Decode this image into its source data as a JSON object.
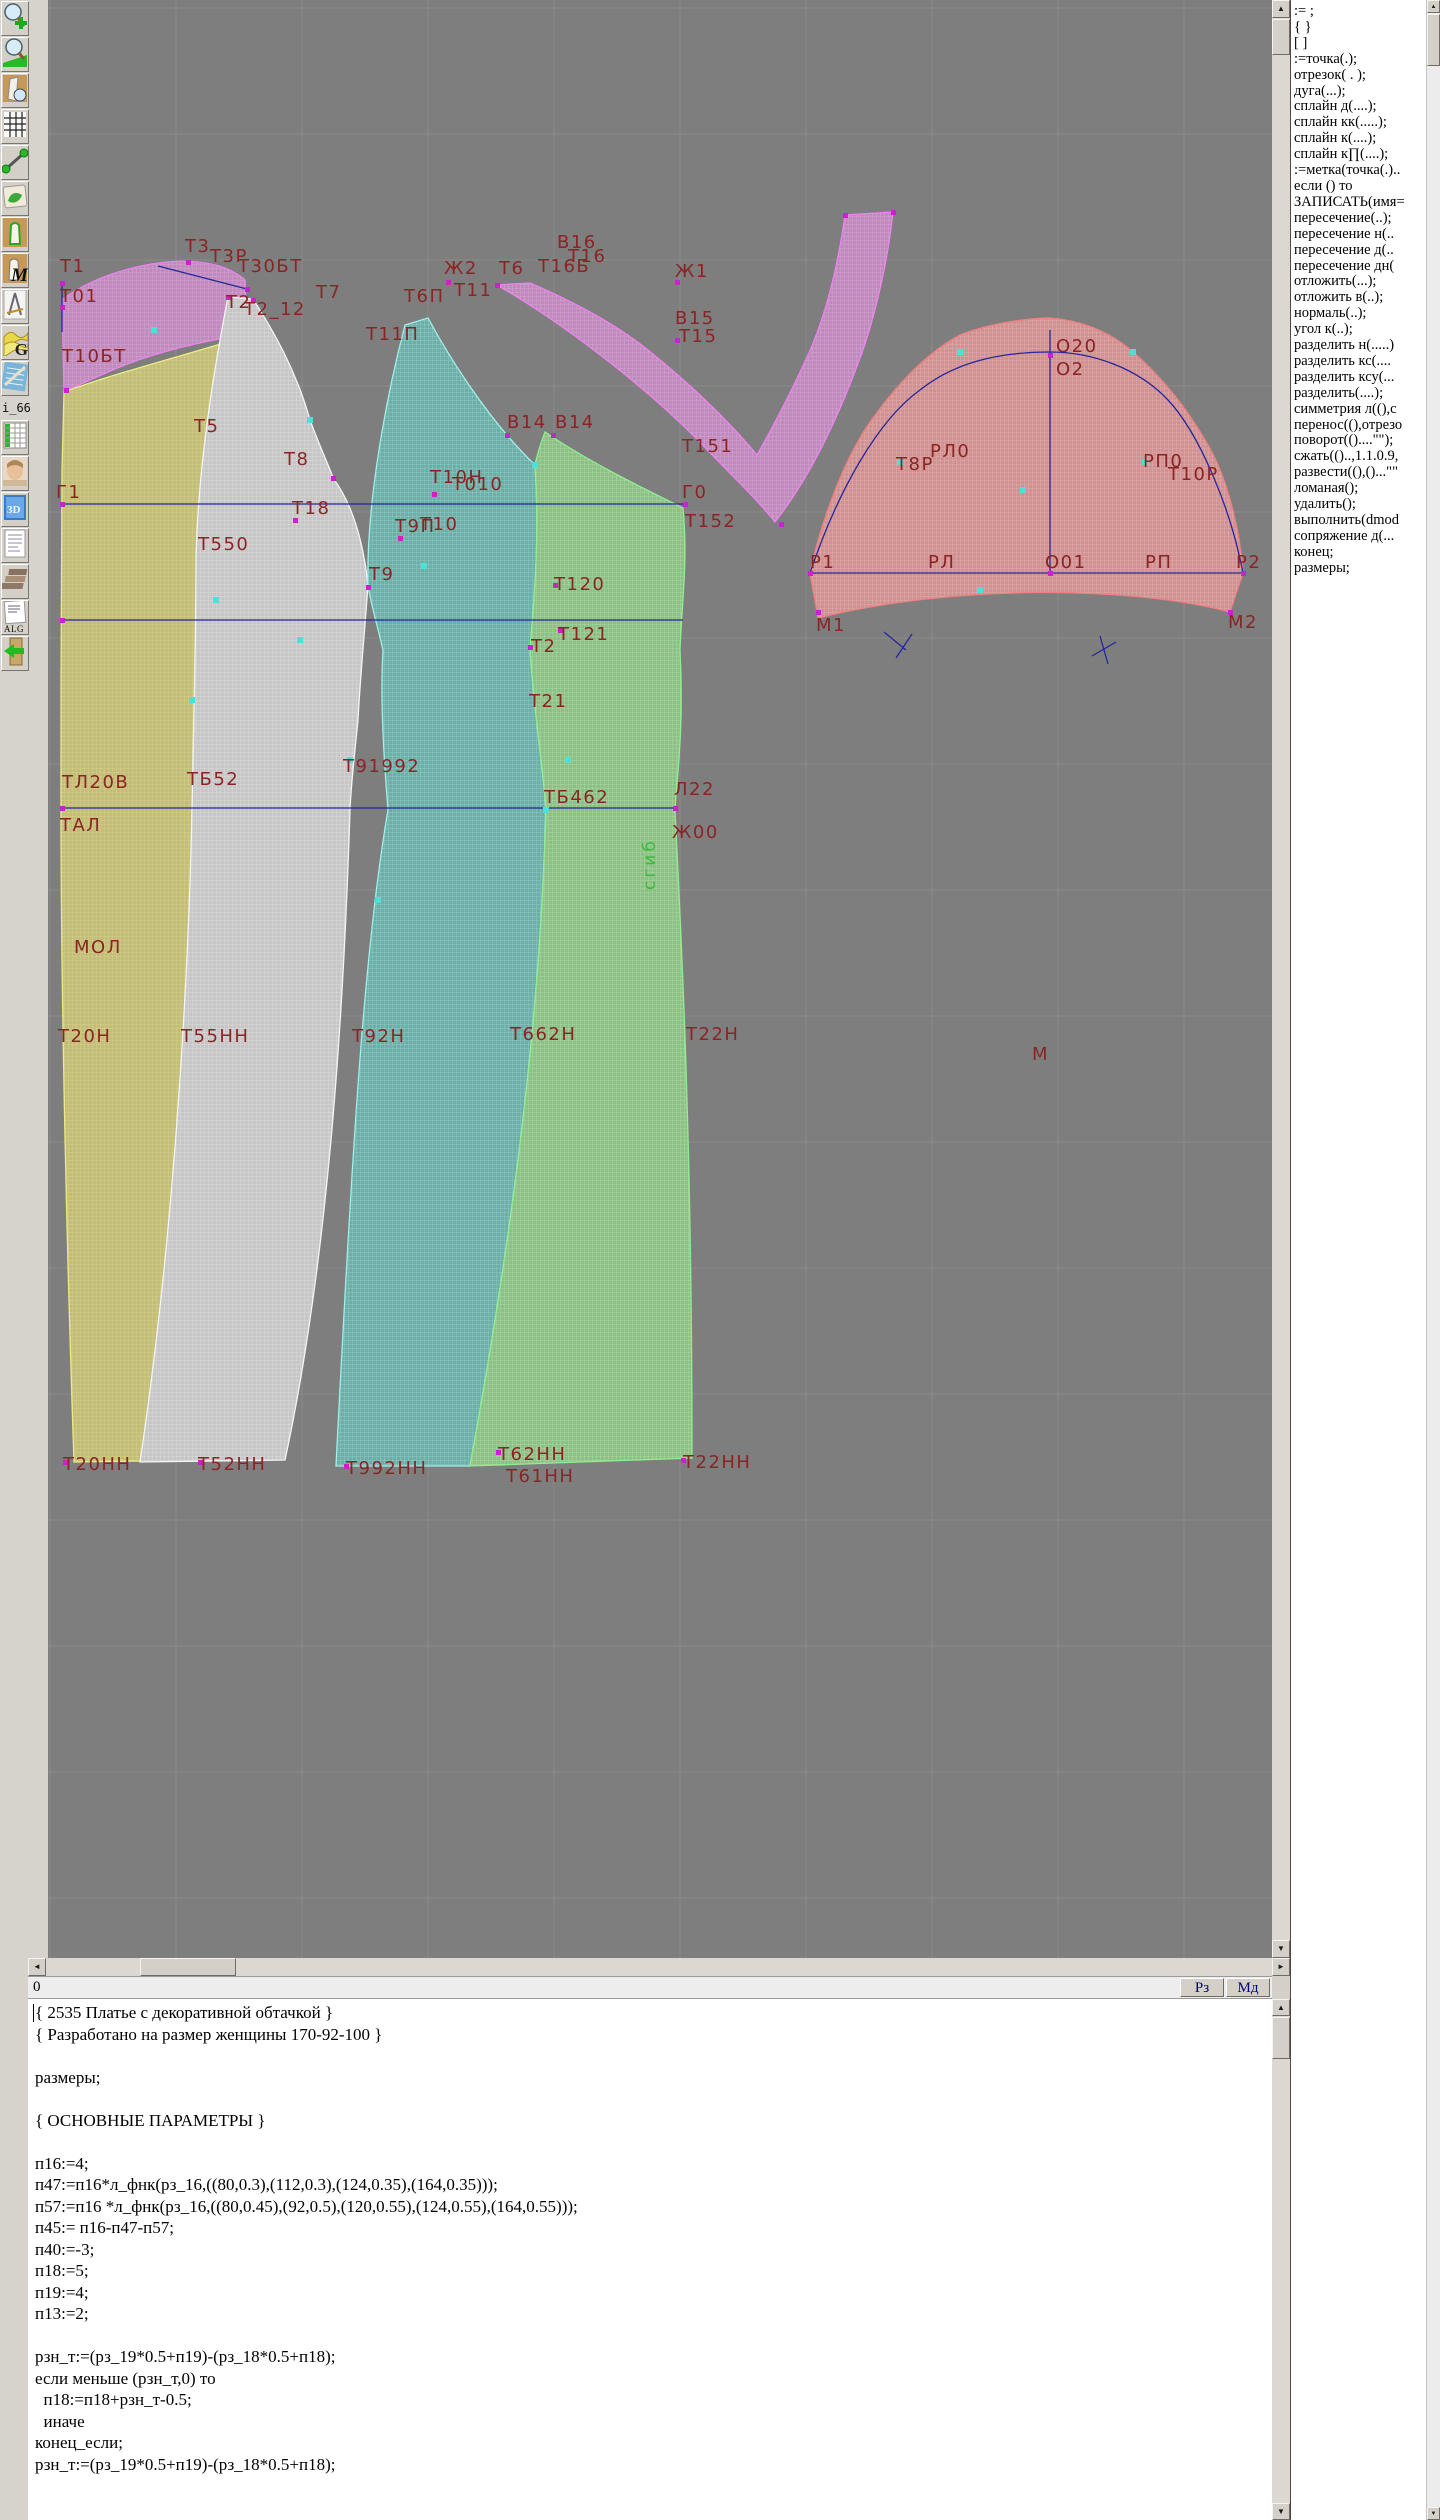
{
  "toolbar": {
    "items": [
      {
        "name": "zoom-in"
      },
      {
        "name": "zoom-out"
      },
      {
        "name": "view-pattern"
      },
      {
        "name": "grid"
      },
      {
        "name": "segment"
      },
      {
        "name": "map"
      },
      {
        "name": "pattern-outline"
      },
      {
        "name": "pattern-m",
        "label": "M"
      },
      {
        "name": "drafting-tools"
      },
      {
        "name": "g-curves",
        "label": "G"
      },
      {
        "name": "blueprint"
      },
      {
        "name": "i66",
        "label": "i_66."
      },
      {
        "name": "table"
      },
      {
        "name": "photo"
      },
      {
        "name": "threed",
        "label": "3D"
      },
      {
        "name": "list"
      },
      {
        "name": "books"
      },
      {
        "name": "alg",
        "label": "ALG"
      },
      {
        "name": "exit"
      }
    ]
  },
  "right_panel": {
    "lines": [
      ":=  ;",
      "{  }",
      "[  ]",
      ":=точка(.);",
      "отрезок( . );",
      "дуга(...);",
      "сплайн  д(....);",
      "сплайн  кк(.....);",
      "сплайн  к(....);",
      "сплайн  к∏(....);",
      ":=метка(точка(.)..",
      "если () то",
      "ЗАПИСАТЬ(имя=",
      "пересечение(..);",
      "пересечение  н(..",
      "пересечение  д(..",
      "пересечение  дн(",
      "отложить(...);",
      "отложить  в(..);",
      "нормаль(..);",
      "угол  к(..);",
      "разделить  н(.....)",
      "разделить  кс(....",
      "разделить  ксу(...",
      "разделить(....);",
      "симметрия  л((),с",
      "перенос((),отрезо",
      "поворот(()....\"\");",
      "сжать(()..,1.1.0.9,",
      "развести((),()...\"\"",
      "ломаная();",
      "удалить();",
      "выполнить(dmod",
      "сопряжение  д(...",
      "конец;",
      "размеры;"
    ]
  },
  "bottom": {
    "ruler_label": "0",
    "buttons": [
      "Рз",
      "Мд"
    ]
  },
  "editor": {
    "lines": [
      "{ 2535 Платье с декоративной обтачкой }",
      "{ Разработано на размер женщины 170-92-100 }",
      "",
      "размеры;",
      "",
      "{ ОСНОВНЫЕ ПАРАМЕТРЫ }",
      "",
      "п16:=4;",
      "п47:=п16*л_фнк(рз_16,((80,0.3),(112,0.3),(124,0.35),(164,0.35)));",
      "п57:=п16 *л_фнк(рз_16,((80,0.45),(92,0.5),(120,0.55),(124,0.55),(164,0.55)));",
      "п45:= п16-п47-п57;",
      "п40:=-3;",
      "п18:=5;",
      "п19:=4;",
      "п13:=2;",
      "",
      "рзн_т:=(рз_19*0.5+п19)-(рз_18*0.5+п18);",
      "если меньше (рзн_т,0) то",
      "  п18:=п18+рзн_т-0.5;",
      "  иначе",
      "конец_если;",
      "рзн_т:=(рз_19*0.5+п19)-(рз_18*0.5+п18);"
    ]
  },
  "canvas": {
    "colors": {
      "bg": "#7e7e7e",
      "grid": "#8a8a8a",
      "line_blue": "#26269c",
      "label_red": "#8b2424",
      "vlabel_green": "#3dbb3d"
    },
    "grid": {
      "spacing": 126,
      "x0": 2,
      "y0": 8
    },
    "pieces": [
      {
        "name": "neck-facing-left",
        "base": "#bf8bbc",
        "mesh": "#dca6d9",
        "edge": "#ee82ee",
        "path": "M14,300 C50,272 110,258 150,262 C170,264 186,270 197,280 L199,334 C150,342 100,354 60,372 C42,380 26,387 16,392 Z"
      },
      {
        "name": "back-panel-yellow",
        "base": "#c2bd7d",
        "mesh": "#dcd77e",
        "edge": "#eeeb84",
        "path": "M16,392 C70,372 150,352 198,336 L203,450 C195,520 172,560 164,620 C156,700 150,760 146,810 C142,980 150,1230 163,1460 L26,1462 C18,1230 13,980 13,810 C13,700 13,560 14,470 Z"
      },
      {
        "name": "side-panel-white",
        "base": "#c6c6c6",
        "mesh": "#e0e0e0",
        "edge": "#f4f4f4",
        "path": "M180,297 L205,299 C225,330 248,370 262,420 C275,455 283,470 285,478 C300,498 314,530 320,585 C316,640 312,680 310,720 C306,760 303,785 302,810 C296,1000 282,1250 237,1460 L92,1462 C124,1250 140,1000 144,810 C146,700 148,640 148,560 C150,470 164,380 180,297 Z"
      },
      {
        "name": "front-panel-teal",
        "base": "#6fada7",
        "mesh": "#92d4ce",
        "edge": "#9ff0e8",
        "path": "M357,325 L380,318 C400,355 440,420 487,465 C492,540 486,600 482,650 C488,730 496,775 498,810 C494,950 480,1150 422,1466 L288,1466 C304,1150 316,950 340,810 C336,760 332,700 335,650 C328,620 322,600 320,585 C318,500 340,390 357,325 Z"
      },
      {
        "name": "front-panel-green",
        "base": "#8fbf88",
        "mesh": "#ace0a0",
        "edge": "#90ee90",
        "path": "M497,432 C550,468 610,495 635,508 C640,560 634,600 632,650 C636,730 629,775 627,810 C634,950 644,1150 644,1458 L422,1466 C480,1150 494,950 498,810 C496,775 488,730 482,650 C486,600 492,540 487,465 C490,450 494,440 497,432 Z"
      },
      {
        "name": "decorative-facing-v",
        "base": "#bf8bbc",
        "mesh": "#dca6d9",
        "edge": "#ee82ee",
        "path": "M449,285 C510,320 590,380 650,440 C680,472 710,500 727,522 C760,480 790,420 815,350 C828,312 840,260 845,212 L797,215 C790,265 778,315 760,355 C745,388 726,425 709,455 C680,420 640,382 600,350 C560,318 510,295 482,283 Z"
      },
      {
        "name": "sleeve-red",
        "base": "#cf9191",
        "mesh": "#e8b2b2",
        "edge": "#f08080",
        "path": "M762,573 C770,535 790,470 820,425 C850,382 880,352 912,335 C945,322 985,318 1002,318 C1030,320 1060,330 1085,352 C1115,378 1140,410 1160,445 C1180,480 1192,530 1195,573 L1182,612 C1080,585 900,585 770,618 Z"
      }
    ],
    "blue_lines": [
      [
        14,
        504,
        638,
        504
      ],
      [
        14,
        620,
        635,
        620
      ],
      [
        14,
        808,
        627,
        808
      ],
      [
        110,
        266,
        199,
        289
      ],
      [
        14,
        283,
        14,
        332
      ],
      [
        762,
        573,
        1195,
        573
      ],
      [
        1002,
        330,
        1002,
        573
      ],
      [
        836,
        632,
        858,
        650
      ],
      [
        848,
        658,
        864,
        634
      ],
      [
        1044,
        656,
        1068,
        642
      ],
      [
        1052,
        636,
        1060,
        664
      ]
    ],
    "blue_curves": [
      "M762,573 C790,490 830,420 872,390 C912,358 962,352 1002,352 C1044,352 1090,368 1120,400 C1150,432 1182,505 1195,573"
    ],
    "markers": {
      "magenta": [
        [
          14,
          283
        ],
        [
          14,
          307
        ],
        [
          18,
          390
        ],
        [
          140,
          262
        ],
        [
          199,
          289
        ],
        [
          180,
          297
        ],
        [
          205,
          300
        ],
        [
          247,
          520
        ],
        [
          285,
          478
        ],
        [
          320,
          587
        ],
        [
          352,
          538
        ],
        [
          386,
          494
        ],
        [
          400,
          282
        ],
        [
          482,
          647
        ],
        [
          507,
          585
        ],
        [
          512,
          630
        ],
        [
          14,
          504
        ],
        [
          14,
          620
        ],
        [
          14,
          808
        ],
        [
          637,
          504
        ],
        [
          627,
          808
        ],
        [
          629,
          282
        ],
        [
          629,
          340
        ],
        [
          733,
          524
        ],
        [
          762,
          573
        ],
        [
          1002,
          355
        ],
        [
          1002,
          573
        ],
        [
          1195,
          573
        ],
        [
          770,
          612
        ],
        [
          1182,
          612
        ],
        [
          459,
          435
        ],
        [
          505,
          435
        ],
        [
          449,
          285
        ],
        [
          797,
          215
        ],
        [
          845,
          212
        ],
        [
          17,
          1462
        ],
        [
          152,
          1462
        ],
        [
          298,
          1466
        ],
        [
          450,
          1452
        ],
        [
          635,
          1460
        ]
      ],
      "cyan": [
        [
          106,
          330
        ],
        [
          376,
          566
        ],
        [
          975,
          490
        ],
        [
          168,
          600
        ],
        [
          262,
          420
        ],
        [
          487,
          465
        ],
        [
          498,
          810
        ],
        [
          852,
          462
        ],
        [
          1097,
          462
        ],
        [
          912,
          352
        ],
        [
          1085,
          352
        ],
        [
          252,
          640
        ],
        [
          330,
          900
        ],
        [
          520,
          760
        ],
        [
          144,
          700
        ],
        [
          302,
          760
        ],
        [
          932,
          590
        ]
      ]
    },
    "labels": [
      [
        "Т1",
        12,
        272
      ],
      [
        "Т01",
        12,
        302
      ],
      [
        "Т10БТ",
        14,
        362
      ],
      [
        "Т3",
        137,
        252
      ],
      [
        "Т3Р",
        162,
        262
      ],
      [
        "Т30БТ",
        190,
        272
      ],
      [
        "Т2",
        178,
        308
      ],
      [
        "Т2_12",
        196,
        315
      ],
      [
        "Т7",
        268,
        298
      ],
      [
        "Т5",
        146,
        432
      ],
      [
        "Т8",
        236,
        465
      ],
      [
        "Т18",
        244,
        514
      ],
      [
        "Т550",
        150,
        550
      ],
      [
        "Т9П",
        347,
        532
      ],
      [
        "Т10",
        372,
        530
      ],
      [
        "Т10Н",
        382,
        483
      ],
      [
        "Т010",
        404,
        490
      ],
      [
        "Т9",
        321,
        580
      ],
      [
        "Т11П",
        318,
        340
      ],
      [
        "Т6П",
        356,
        302
      ],
      [
        "Ж2",
        396,
        274
      ],
      [
        "Т11",
        406,
        296
      ],
      [
        "Т6",
        451,
        274
      ],
      [
        "Т16Б",
        490,
        272
      ],
      [
        "В16",
        509,
        248
      ],
      [
        "Т16",
        520,
        262
      ],
      [
        "Ж1",
        627,
        277
      ],
      [
        "В15",
        627,
        324
      ],
      [
        "Т15",
        631,
        342
      ],
      [
        "В14",
        459,
        428
      ],
      [
        "В14",
        507,
        428
      ],
      [
        "Т151",
        634,
        452
      ],
      [
        "Г0",
        634,
        498
      ],
      [
        "Т152",
        637,
        527
      ],
      [
        "Г1",
        8,
        498
      ],
      [
        "Т120",
        506,
        590
      ],
      [
        "Т121",
        510,
        640
      ],
      [
        "Т2",
        483,
        652
      ],
      [
        "Т21",
        481,
        707
      ],
      [
        "ТЛ20В",
        14,
        788
      ],
      [
        "ТБ52",
        139,
        785
      ],
      [
        "Т91992",
        295,
        772
      ],
      [
        "ТБ462",
        496,
        803
      ],
      [
        "Л22",
        626,
        795
      ],
      [
        "Ж00",
        624,
        838
      ],
      [
        "ТАЛ",
        12,
        831
      ],
      [
        "МОЛ",
        26,
        953
      ],
      [
        "Т20Н",
        10,
        1042
      ],
      [
        "Т55НН",
        133,
        1042
      ],
      [
        "Т92Н",
        304,
        1042
      ],
      [
        "Т662Н",
        462,
        1040
      ],
      [
        "Т22Н",
        638,
        1040
      ],
      [
        "М",
        984,
        1060
      ],
      [
        "Т20НН",
        15,
        1470
      ],
      [
        "Т52НН",
        150,
        1470
      ],
      [
        "Т992НН",
        298,
        1474
      ],
      [
        "Т62НН",
        450,
        1460
      ],
      [
        "Т61НН",
        458,
        1482
      ],
      [
        "Т22НН",
        635,
        1468
      ],
      [
        "О20",
        1008,
        352
      ],
      [
        "О2",
        1008,
        375
      ],
      [
        "РЛ0",
        882,
        457
      ],
      [
        "Т8Р",
        848,
        470
      ],
      [
        "РП0",
        1095,
        467
      ],
      [
        "Т10Р",
        1120,
        480
      ],
      [
        "Р1",
        762,
        568
      ],
      [
        "РЛ",
        880,
        568
      ],
      [
        "О01",
        997,
        568
      ],
      [
        "РП",
        1097,
        568
      ],
      [
        "Р2",
        1188,
        568
      ],
      [
        "М1",
        768,
        631
      ],
      [
        "М2",
        1180,
        628
      ]
    ],
    "vertical_label": {
      "text": "сгиб",
      "x": 607,
      "y": 890
    }
  }
}
